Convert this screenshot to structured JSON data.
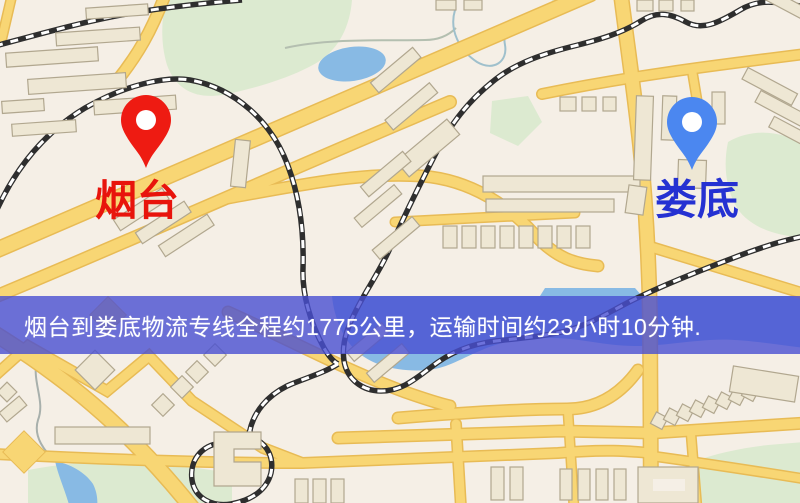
{
  "origin": {
    "label": "烟台",
    "pin_color": "#ee1b12",
    "label_color": "#e8140c"
  },
  "destination": {
    "label": "娄底",
    "pin_color": "#4b87f0",
    "label_color": "#2531d2"
  },
  "banner": {
    "text": "烟台到娄底物流专线全程约1775公里，运输时间约23小时10分钟.",
    "background": "#484fd2",
    "opacity": "0.8",
    "text_color": "#ffffff"
  },
  "map_colors": {
    "land": "#f5efe6",
    "road_fill": "#f8d674",
    "road_casing": "#e8bb55",
    "water": "#88bae4",
    "park": "#dcead0",
    "building_fill": "#eee7d4",
    "building_stroke": "#b1a78f",
    "railway": "#2e2e2e",
    "railway_dash": "#ffffff"
  }
}
